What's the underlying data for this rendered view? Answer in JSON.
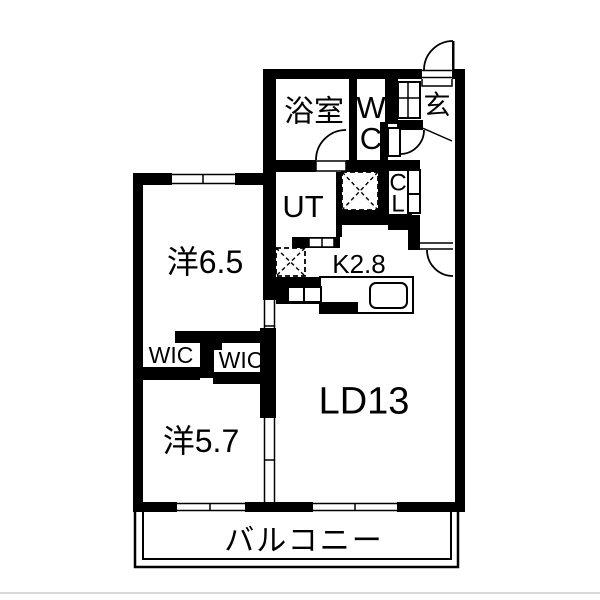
{
  "title": "apartment-floorplan",
  "rooms": {
    "bathroom": {
      "label": "浴室"
    },
    "wc": {
      "line1": "W",
      "line2": "C"
    },
    "entrance": {
      "label": "玄"
    },
    "utility": {
      "label": "UT"
    },
    "closet": {
      "line1": "C",
      "line2": "L"
    },
    "kitchen": {
      "label": "K2.8"
    },
    "bedroom1": {
      "label": "洋6.5"
    },
    "wic_left": {
      "label": "WIC"
    },
    "wic_right": {
      "label": "WIC"
    },
    "bedroom2": {
      "label": "洋5.7"
    },
    "living_dining": {
      "label": "LD13"
    },
    "balcony": {
      "label": "バルコニー"
    }
  },
  "colors": {
    "wall": "#000000",
    "background": "#ffffff",
    "baseline_gray": "#d9d9d9"
  }
}
